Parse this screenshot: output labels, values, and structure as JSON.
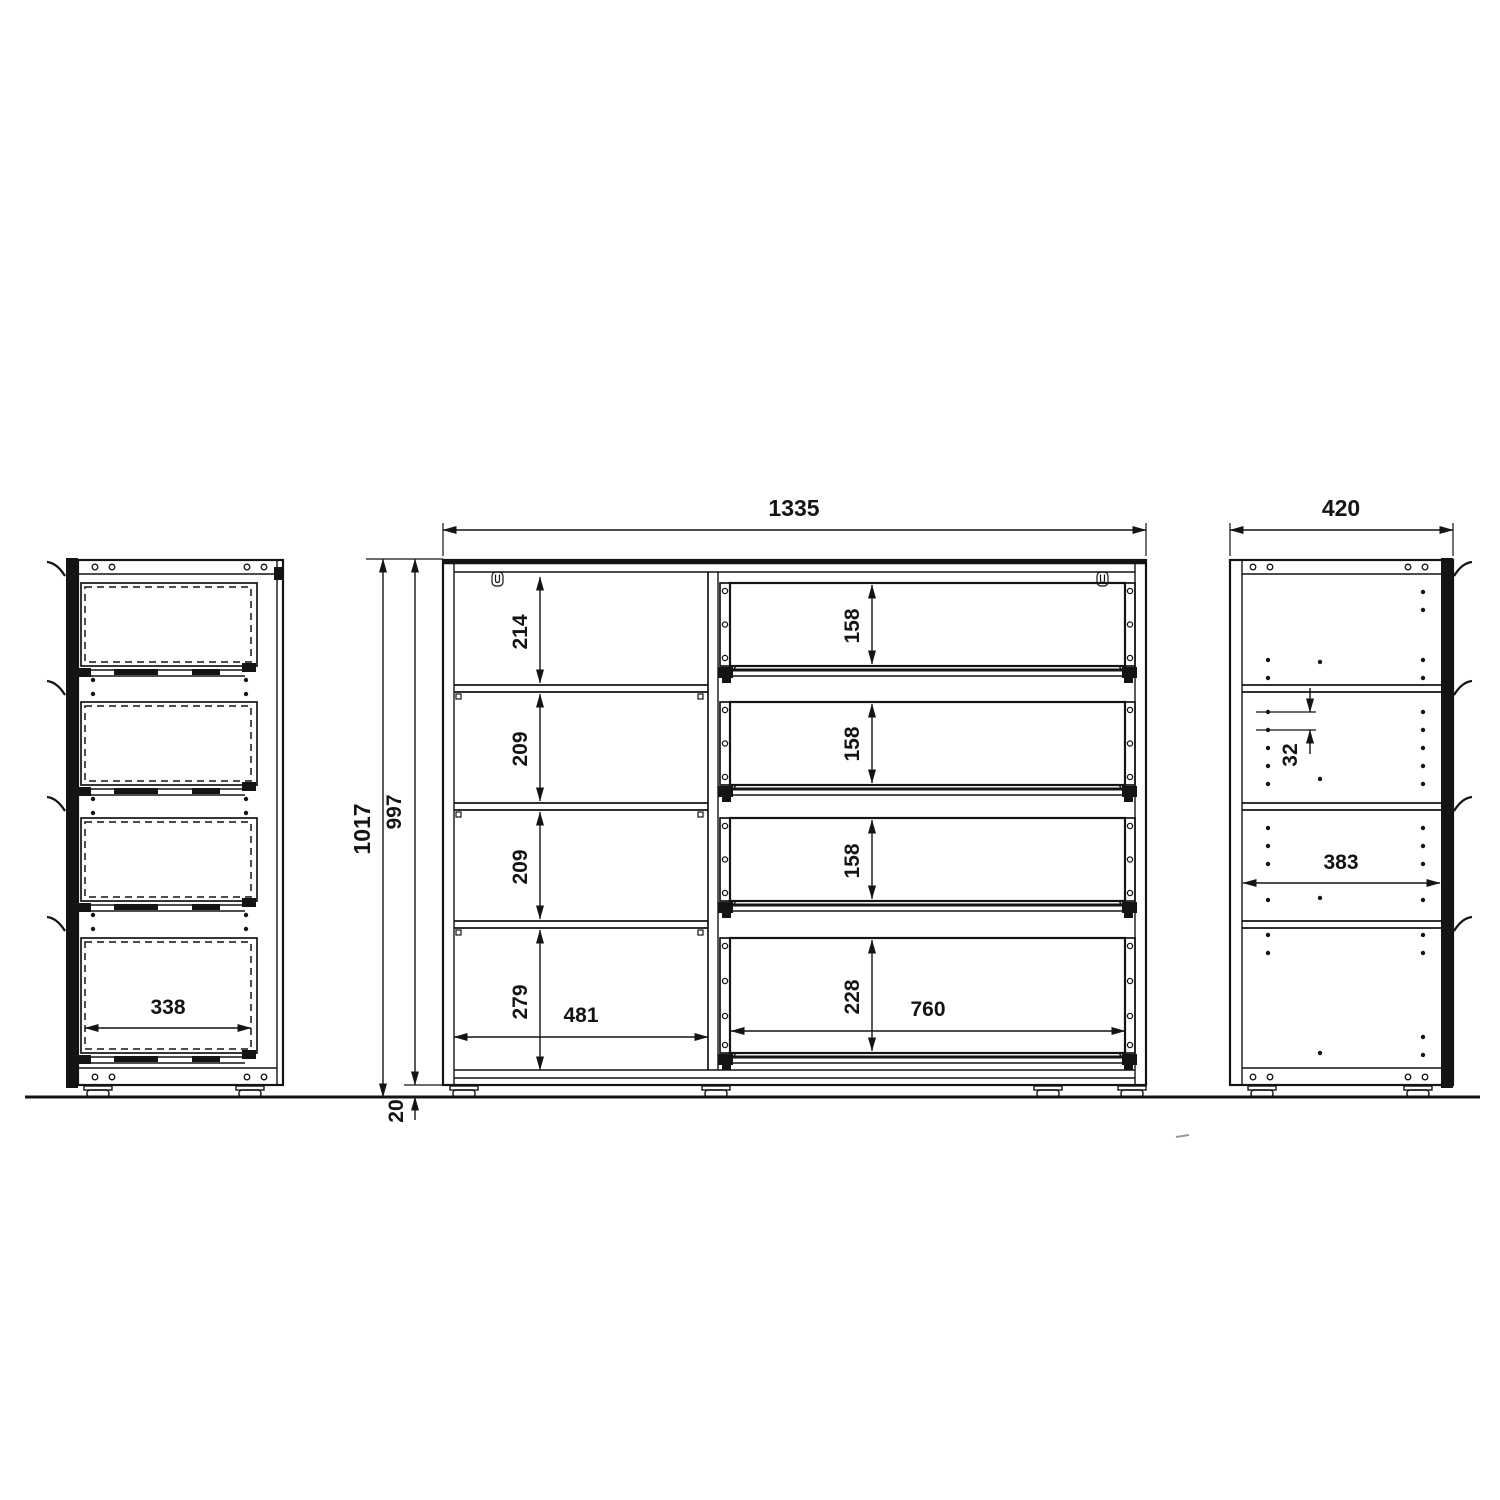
{
  "drawing": {
    "type": "furniture technical drawing, three orthographic views of a sideboard with shelves and four drawers",
    "background_color": "#ffffff",
    "line_color": "#141414",
    "units": "mm"
  },
  "dimensions": {
    "front_view": {
      "overall_width": "1335",
      "overall_height": "1017",
      "carcass_height": "997",
      "foot_height": "20",
      "compartment_1_height": "214",
      "compartment_2_height": "209",
      "compartment_3_height": "209",
      "compartment_4_height": "279",
      "shelf_section_inner_width": "481",
      "drawer_1_inner_height": "158",
      "drawer_2_inner_height": "158",
      "drawer_3_inner_height": "158",
      "drawer_4_inner_height": "228",
      "drawer_inner_width": "760"
    },
    "left_side_view": {
      "drawer_inner_depth": "338"
    },
    "right_side_view": {
      "overall_depth": "420",
      "shelf_hole_pitch": "32",
      "inner_depth": "383"
    }
  }
}
